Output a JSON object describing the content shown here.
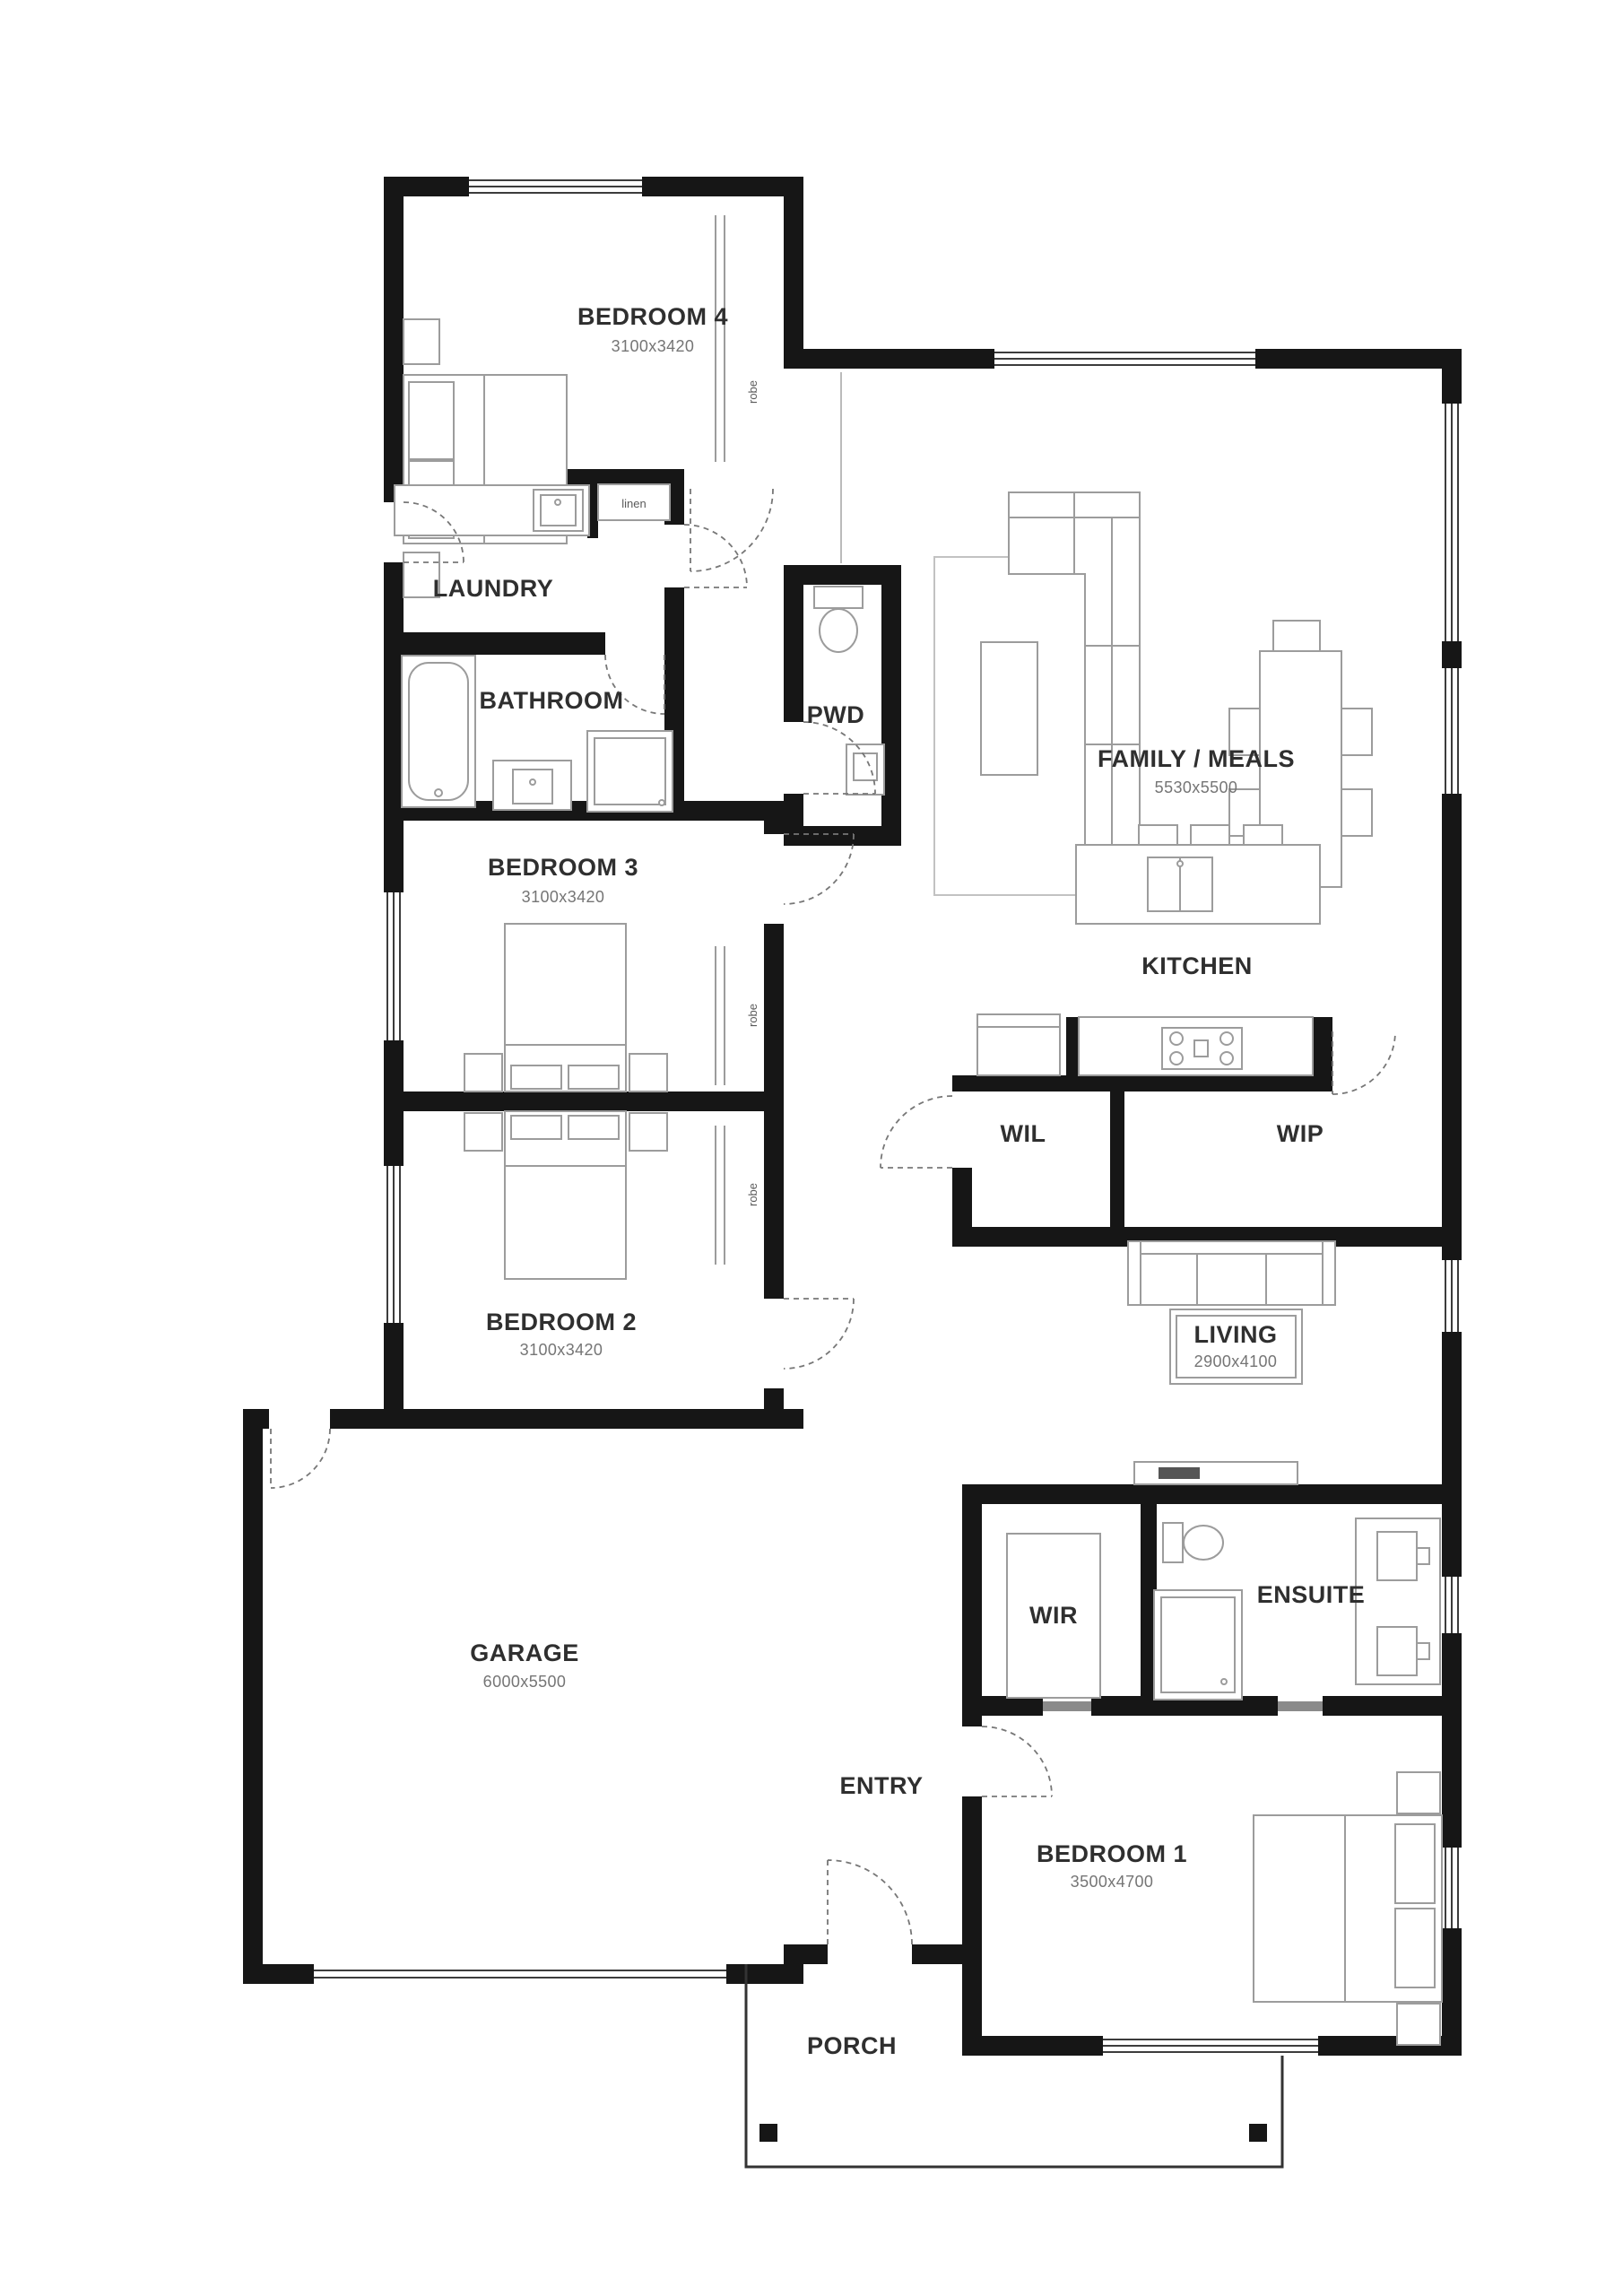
{
  "plan": {
    "title": "house-floor-plan",
    "colors": {
      "wall": "#161616",
      "furniture": "#9c9c9c",
      "label": "#2f2f2f",
      "dim": "#757575"
    },
    "rooms": {
      "bedroom4": {
        "name": "BEDROOM 4",
        "dims": "3100x3420"
      },
      "laundry": {
        "name": "LAUNDRY"
      },
      "linen": {
        "name": "linen"
      },
      "bathroom": {
        "name": "BATHROOM"
      },
      "pwd": {
        "name": "PWD"
      },
      "family": {
        "name": "FAMILY / MEALS",
        "dims": "5530x5500"
      },
      "kitchen": {
        "name": "KITCHEN"
      },
      "bedroom3": {
        "name": "BEDROOM 3",
        "dims": "3100x3420"
      },
      "wil": {
        "name": "WIL"
      },
      "wip": {
        "name": "WIP"
      },
      "bedroom2": {
        "name": "BEDROOM 2",
        "dims": "3100x3420"
      },
      "living": {
        "name": "LIVING",
        "dims": "2900x4100"
      },
      "garage": {
        "name": "GARAGE",
        "dims": "6000x5500"
      },
      "wir": {
        "name": "WIR"
      },
      "ensuite": {
        "name": "ENSUITE"
      },
      "entry": {
        "name": "ENTRY"
      },
      "bedroom1": {
        "name": "BEDROOM 1",
        "dims": "3500x4700"
      },
      "porch": {
        "name": "PORCH"
      },
      "robe": {
        "name": "robe"
      }
    }
  }
}
